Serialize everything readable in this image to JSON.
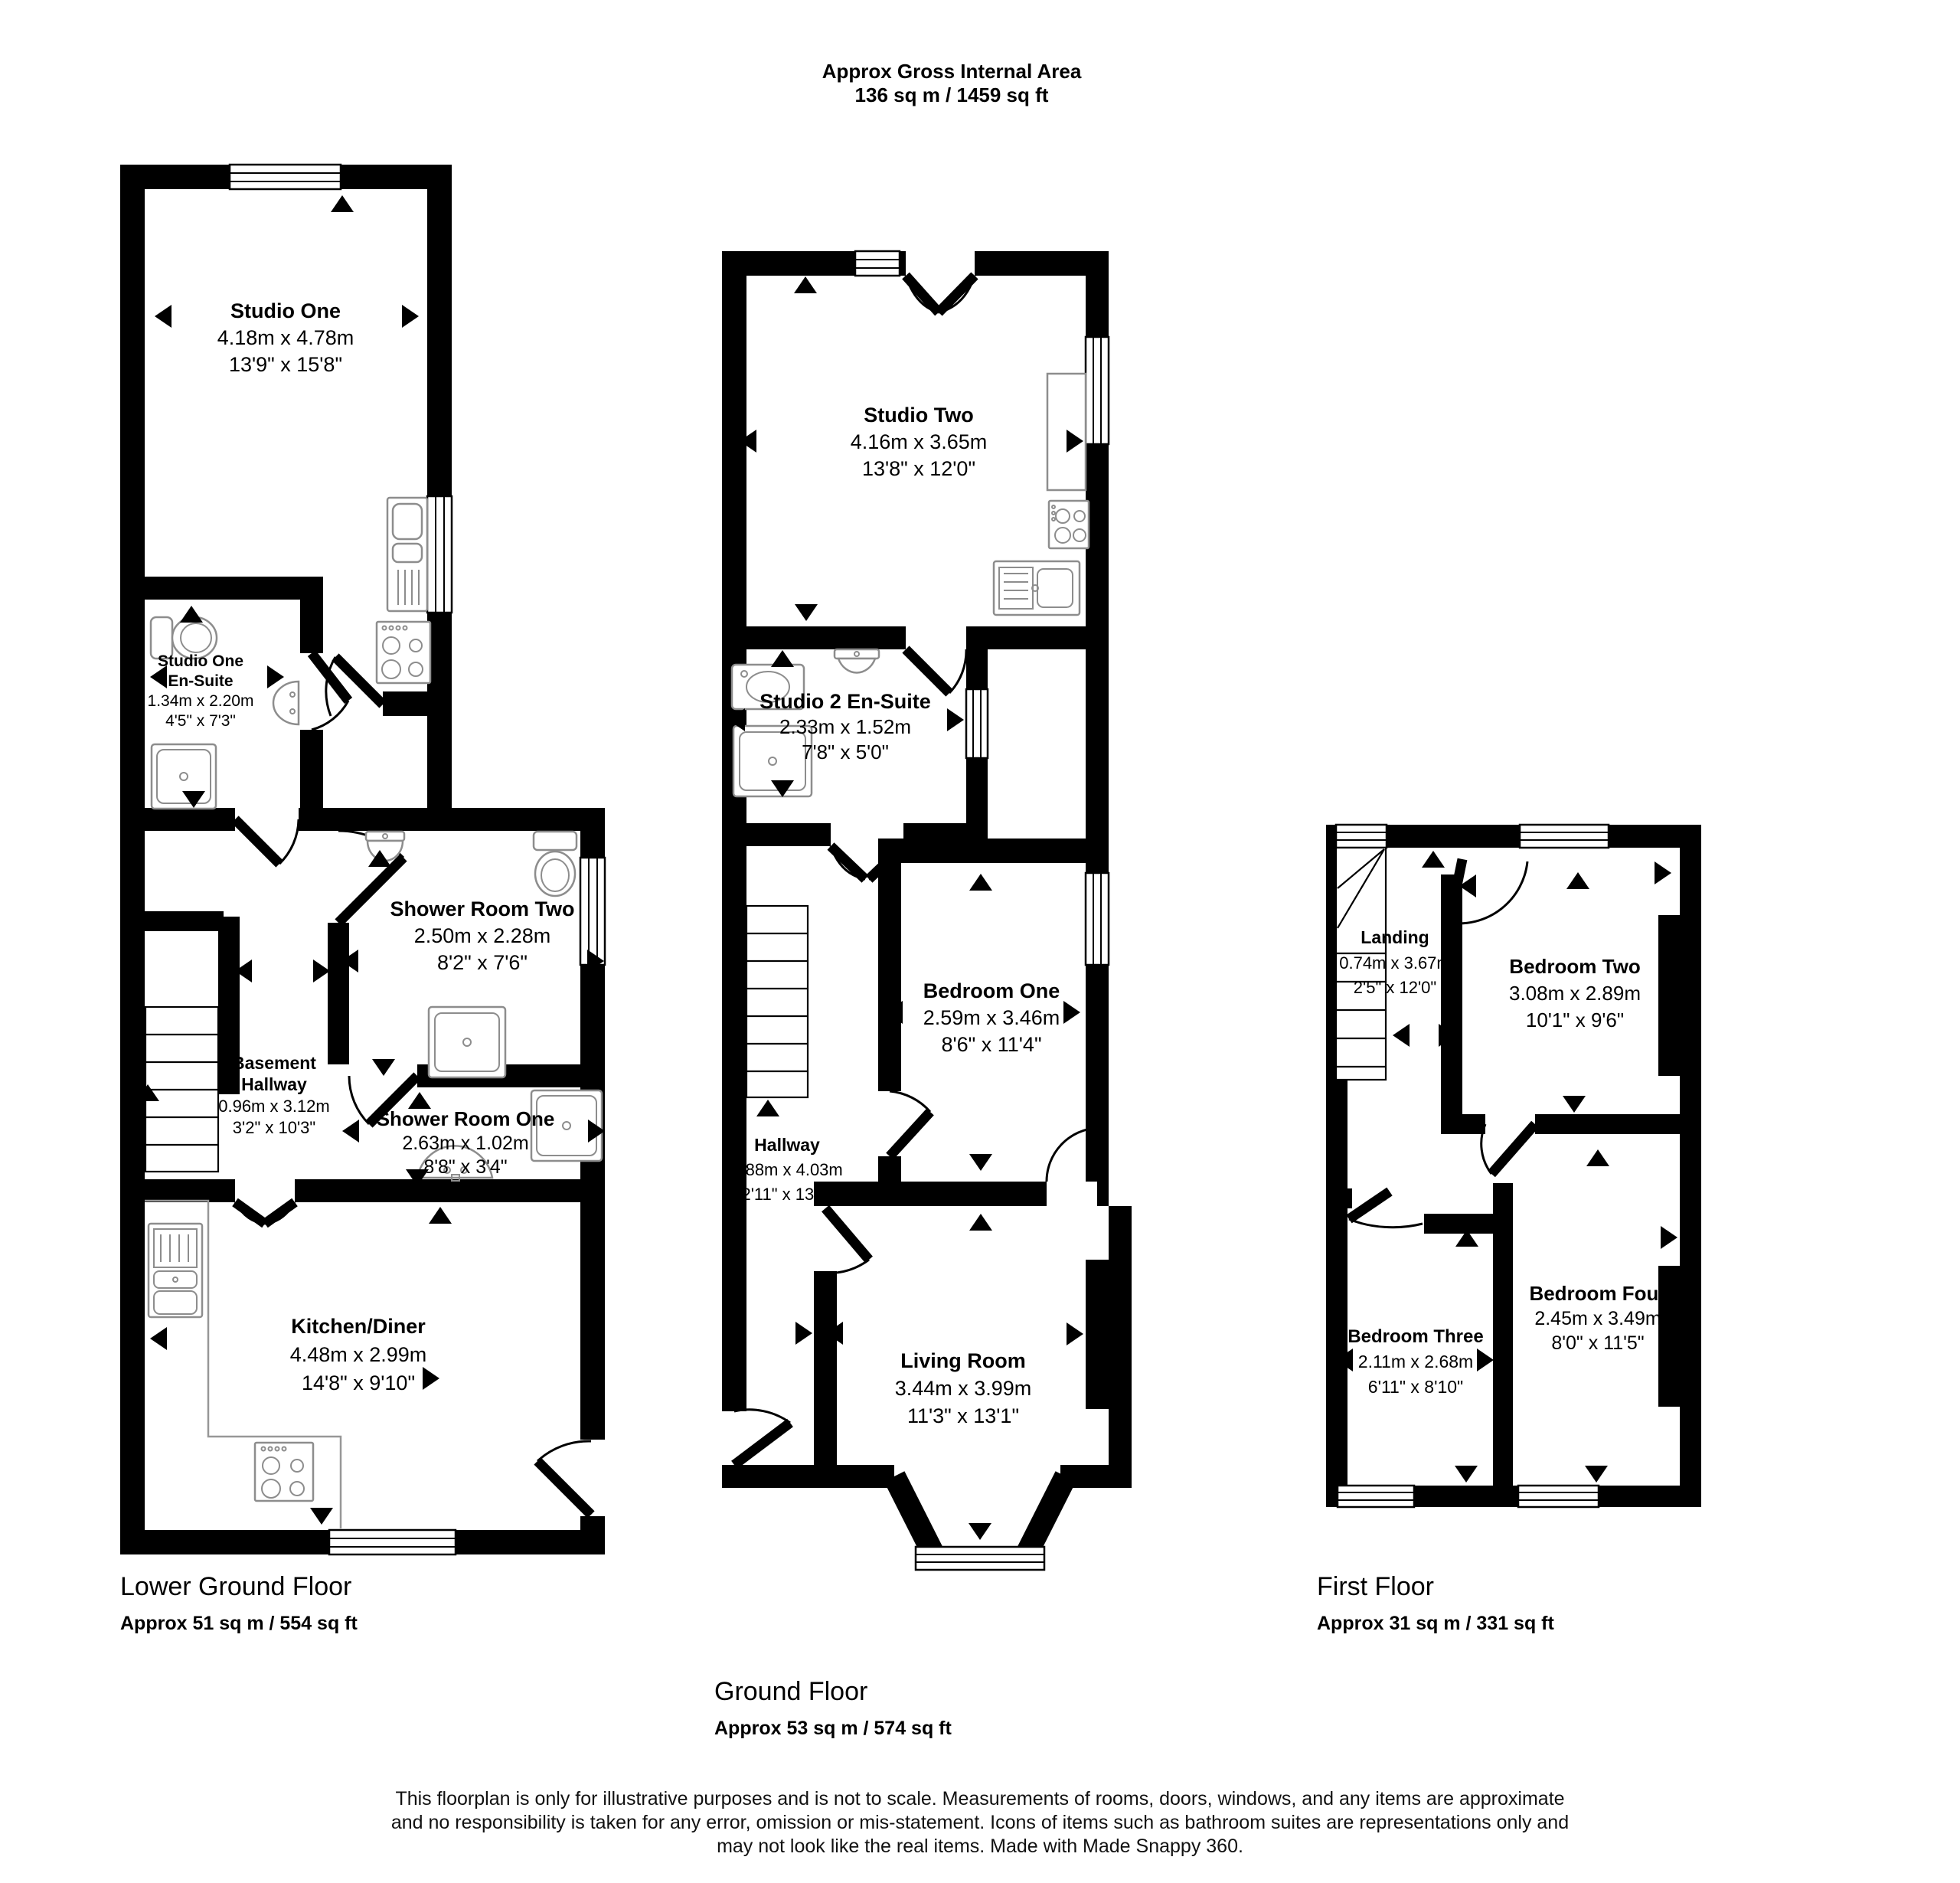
{
  "header": {
    "line1": "Approx Gross Internal Area",
    "line2": "136 sq m / 1459 sq ft"
  },
  "floors": [
    {
      "label": "Lower Ground Floor",
      "area": "Approx 51 sq m / 554 sq ft",
      "rooms": [
        {
          "name": "Studio One",
          "metric": "4.18m x 4.78m",
          "imperial": "13'9\" x 15'8\""
        },
        {
          "name": "Studio One En-Suite",
          "name_lines": [
            "Studio One",
            "En-Suite"
          ],
          "metric": "1.34m x 2.20m",
          "imperial": "4'5\" x 7'3\""
        },
        {
          "name": "Shower Room Two",
          "metric": "2.50m x 2.28m",
          "imperial": "8'2\" x 7'6\""
        },
        {
          "name": "Basement Hallway",
          "name_lines": [
            "Basement",
            "Hallway"
          ],
          "metric": "0.96m x 3.12m",
          "imperial": "3'2\" x 10'3\""
        },
        {
          "name": "Shower Room One",
          "metric": "2.63m x 1.02m",
          "imperial": "8'8\" x 3'4\""
        },
        {
          "name": "Kitchen/Diner",
          "metric": "4.48m x 2.99m",
          "imperial": "14'8\" x 9'10\""
        }
      ]
    },
    {
      "label": "Ground Floor",
      "area": "Approx 53 sq m / 574 sq ft",
      "rooms": [
        {
          "name": "Studio Two",
          "metric": "4.16m x 3.65m",
          "imperial": "13'8\" x 12'0\""
        },
        {
          "name": "Studio 2 En-Suite",
          "metric": "2.33m x 1.52m",
          "imperial": "7'8\" x 5'0\""
        },
        {
          "name": "Bedroom One",
          "metric": "2.59m x 3.46m",
          "imperial": "8'6\" x 11'4\""
        },
        {
          "name": "Hallway",
          "metric": "0.88m x 4.03m",
          "imperial": "2'11\" x 13'3\""
        },
        {
          "name": "Living Room",
          "metric": "3.44m x 3.99m",
          "imperial": "11'3\" x 13'1\""
        }
      ]
    },
    {
      "label": "First Floor",
      "area": "Approx 31 sq m / 331 sq ft",
      "rooms": [
        {
          "name": "Landing",
          "metric": "0.74m x 3.67m",
          "imperial": "2'5\" x 12'0\""
        },
        {
          "name": "Bedroom Two",
          "metric": "3.08m x 2.89m",
          "imperial": "10'1\" x 9'6\""
        },
        {
          "name": "Bedroom Three",
          "metric": "2.11m x 2.68m",
          "imperial": "6'11\" x 8'10\""
        },
        {
          "name": "Bedroom Four",
          "metric": "2.45m x 3.49m",
          "imperial": "8'0\" x 11'5\""
        }
      ]
    }
  ],
  "footer": {
    "lines": [
      "This floorplan is only for illustrative purposes and is not to scale. Measurements of rooms, doors, windows, and any items are approximate",
      "and no responsibility is taken for any error, omission or mis-statement. Icons of items such as bathroom suites are representations only and",
      "may not look like the real items. Made with Made Snappy 360."
    ]
  }
}
